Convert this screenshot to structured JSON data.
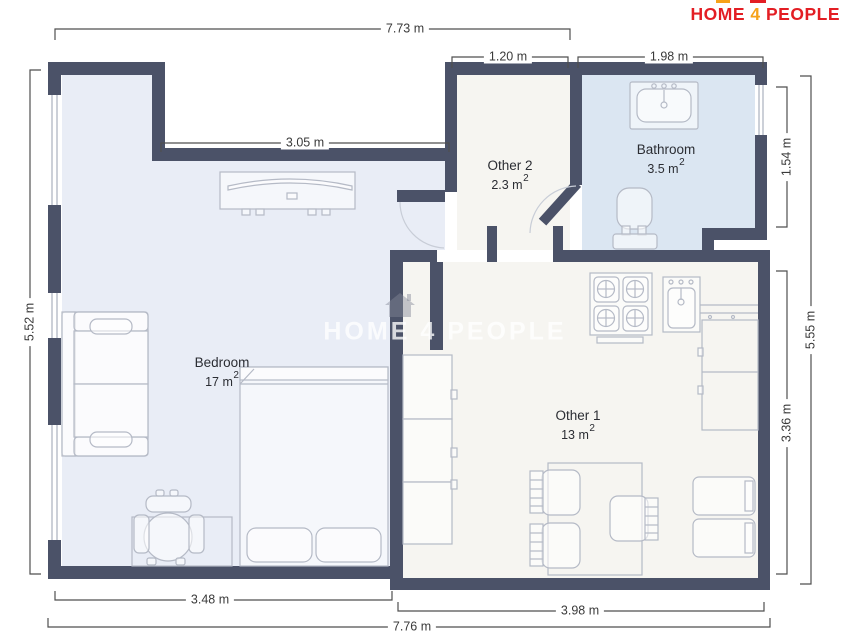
{
  "logo": {
    "home": "HOME",
    "four": "4",
    "people": "PEOPLE"
  },
  "watermark": {
    "home": "HOME",
    "four": "4",
    "people": "PEOPLE"
  },
  "rooms": [
    {
      "name": "Bedroom",
      "area_value": "17 m",
      "area_sup": "2"
    },
    {
      "name": "Other 1",
      "area_value": "13 m",
      "area_sup": "2"
    },
    {
      "name": "Other 2",
      "area_value": "2.3 m",
      "area_sup": "2"
    },
    {
      "name": "Bathroom",
      "area_value": "3.5 m",
      "area_sup": "2"
    }
  ],
  "dimensions": {
    "top_total": "7.73 m",
    "top_other2": "1.20 m",
    "top_bathroom": "1.98 m",
    "bedroom_top_wall": "3.05 m",
    "left_total": "5.52 m",
    "right_bathroom": "1.54 m",
    "right_other1": "3.36 m",
    "right_total": "5.55 m",
    "bottom_bedroom": "3.48 m",
    "bottom_other1": "3.98 m",
    "bottom_total": "7.76 m"
  },
  "colors": {
    "wall": "#4b5268",
    "bedroom_fill": "#e9edf6",
    "bathroom_fill": "#dbe6f2",
    "other_room_fill": "#f6f5f1",
    "furniture_stroke": "#b5bac6",
    "window_line": "#9aa2b0",
    "dimension_line": "#4f4f4f",
    "logo_red": "#e31e24",
    "logo_yellow": "#f6a21a",
    "watermark_color": "rgba(255,255,255,0.78)"
  }
}
